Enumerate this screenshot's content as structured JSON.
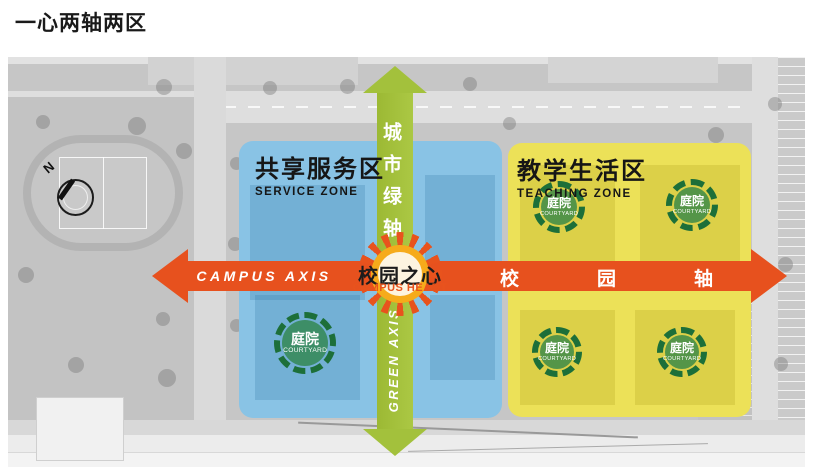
{
  "slide": {
    "title": "一心两轴两区"
  },
  "zones": {
    "service": {
      "title_zh": "共享服务区",
      "title_en": "SERVICE ZONE"
    },
    "teaching": {
      "title_zh": "教学生活区",
      "title_en": "TEACHING ZONE"
    }
  },
  "axes": {
    "city_green": {
      "title_zh": "城市绿轴",
      "title_en": "GREEN AXIS"
    },
    "campus": {
      "title_zh": "校园轴",
      "title_en": "CAMPUS AXIS"
    }
  },
  "heart": {
    "title_zh": "校园之心",
    "title_en": "CAMPUS HEART"
  },
  "courtyard": {
    "title_zh": "庭院",
    "title_en": "COURTYARD"
  },
  "compass": {
    "north_label": "N"
  },
  "colors": {
    "service_zone": "#89C3E5",
    "teaching_zone": "#ECE158",
    "green_axis": "#A3C13C",
    "campus_axis": "#E7511E",
    "courtyard_ring": "#1D6F39",
    "heart_orange": "#E8531D"
  }
}
